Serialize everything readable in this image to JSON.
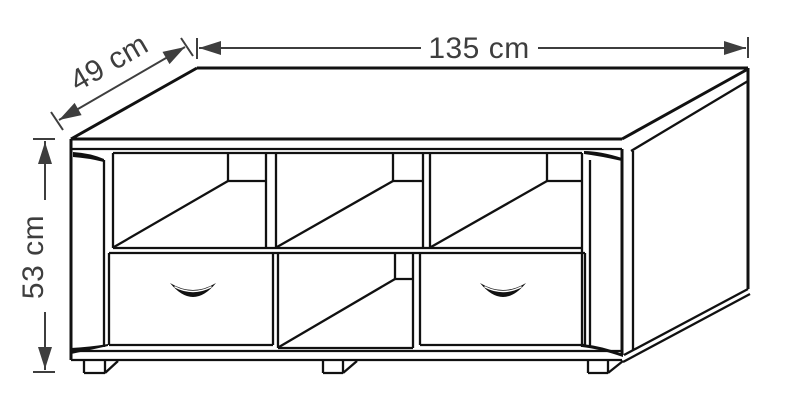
{
  "style": {
    "line_color": "#111111",
    "dim_color": "#3e3e3e",
    "bg": "#ffffff"
  },
  "dimensions": {
    "width": {
      "label": "135 cm"
    },
    "depth": {
      "label": "49 cm"
    },
    "height": {
      "label": "53 cm"
    }
  },
  "diagram": {
    "canvas": {
      "w": 800,
      "h": 418
    },
    "labels": {
      "width": {
        "text": "135 cm",
        "transform": "translate(479,58)"
      },
      "depth": {
        "text": "49 cm",
        "transform": "translate(114,71) rotate(-30)"
      },
      "height": {
        "text": "53 cm",
        "transform": "translate(43,257) rotate(-90)"
      }
    },
    "segments": [
      {
        "n": "top-front-edge",
        "p": [
          71,
          139,
          622,
          139
        ],
        "w": 3
      },
      {
        "n": "top-slab-underside-front",
        "p": [
          71,
          149,
          622,
          149
        ]
      },
      {
        "n": "top-right-edge",
        "p": [
          622,
          139,
          748,
          69
        ],
        "w": 3
      },
      {
        "n": "top-slab-underside-right",
        "p": [
          631,
          151,
          748,
          81
        ]
      },
      {
        "n": "top-back-edge",
        "p": [
          197,
          68,
          748,
          68
        ],
        "w": 3
      },
      {
        "n": "top-left-edge",
        "p": [
          71,
          139,
          197,
          68
        ],
        "w": 3
      },
      {
        "n": "back-right-corner-edge",
        "p": [
          748,
          68,
          748,
          289
        ],
        "w": 3
      },
      {
        "n": "left-outer-edge",
        "p": [
          71,
          139,
          71,
          360
        ],
        "w": 3
      },
      {
        "n": "left-pillar-inner-edge",
        "p": [
          104,
          160,
          104,
          347
        ]
      },
      {
        "n": "opening-left-wall",
        "p": [
          113,
          153,
          113,
          248
        ]
      },
      {
        "n": "right-pillar-outer-edge",
        "p": [
          622,
          149,
          622,
          355
        ],
        "w": 3
      },
      {
        "n": "right-pillar-inner-edge",
        "p": [
          590,
          160,
          590,
          346
        ]
      },
      {
        "n": "opening-right-wall",
        "p": [
          582,
          153,
          582,
          347
        ]
      },
      {
        "n": "side-panel-front-edge",
        "p": [
          633,
          151,
          633,
          350
        ]
      },
      {
        "n": "opening-top-edge",
        "p": [
          113,
          153,
          582,
          153
        ]
      },
      {
        "n": "divider1-left-edge",
        "p": [
          266,
          153,
          266,
          248
        ]
      },
      {
        "n": "divider1-right-edge",
        "p": [
          276,
          153,
          276,
          248
        ]
      },
      {
        "n": "divider2-left-edge",
        "p": [
          423,
          153,
          423,
          248
        ]
      },
      {
        "n": "divider2-right-edge",
        "p": [
          430,
          153,
          430,
          248
        ]
      },
      {
        "n": "cubby-left-depth-diagonal",
        "p": [
          114,
          247,
          228,
          181
        ]
      },
      {
        "n": "cubby-left-back-bottom",
        "p": [
          228,
          181,
          266,
          181
        ]
      },
      {
        "n": "cubby-left-back-corner",
        "p": [
          228,
          153,
          228,
          181
        ]
      },
      {
        "n": "cubby-mid-depth-diagonal",
        "p": [
          277,
          247,
          393,
          181
        ]
      },
      {
        "n": "cubby-mid-back-bottom",
        "p": [
          393,
          181,
          423,
          181
        ]
      },
      {
        "n": "cubby-mid-back-corner",
        "p": [
          393,
          153,
          393,
          181
        ]
      },
      {
        "n": "cubby-right-depth-diagonal",
        "p": [
          431,
          247,
          547,
          181
        ]
      },
      {
        "n": "cubby-right-back-bottom",
        "p": [
          547,
          181,
          582,
          181
        ]
      },
      {
        "n": "cubby-right-back-corner",
        "p": [
          547,
          153,
          547,
          181
        ]
      },
      {
        "n": "mid-shelf-top-edge",
        "p": [
          113,
          248,
          582,
          248
        ]
      },
      {
        "n": "mid-shelf-bottom-edge",
        "p": [
          109,
          253,
          585,
          253
        ]
      },
      {
        "n": "left-drawer-left-edge",
        "p": [
          109,
          253,
          109,
          345
        ]
      },
      {
        "n": "left-drawer-right-edge",
        "p": [
          273,
          253,
          273,
          345
        ]
      },
      {
        "n": "left-drawer-bottom-edge",
        "p": [
          109,
          345,
          273,
          345
        ]
      },
      {
        "n": "lower-comp-left-wall",
        "p": [
          278,
          253,
          278,
          348
        ]
      },
      {
        "n": "lower-comp-right-wall",
        "p": [
          413,
          253,
          413,
          348
        ]
      },
      {
        "n": "lower-comp-bottom-edge",
        "p": [
          278,
          348,
          413,
          348
        ]
      },
      {
        "n": "lower-comp-depth-diagonal",
        "p": [
          279,
          347,
          395,
          279
        ]
      },
      {
        "n": "lower-comp-back-bottom",
        "p": [
          395,
          279,
          413,
          279
        ]
      },
      {
        "n": "lower-comp-back-corner",
        "p": [
          395,
          253,
          395,
          279
        ]
      },
      {
        "n": "right-drawer-left-edge",
        "p": [
          420,
          253,
          420,
          345
        ]
      },
      {
        "n": "right-drawer-right-edge",
        "p": [
          585,
          253,
          585,
          345
        ]
      },
      {
        "n": "right-drawer-bottom-edge",
        "p": [
          420,
          345,
          585,
          345
        ]
      },
      {
        "n": "plinth-top-edge",
        "p": [
          71,
          351,
          622,
          351
        ]
      },
      {
        "n": "plinth-bottom-edge",
        "p": [
          71,
          360,
          622,
          360
        ]
      },
      {
        "n": "base-right-top-diagonal",
        "p": [
          624,
          355,
          748,
          289
        ]
      },
      {
        "n": "base-right-bottom-diagonal",
        "p": [
          623,
          362,
          750,
          294
        ]
      },
      {
        "n": "foot1-left-edge",
        "p": [
          84,
          360,
          84,
          373
        ]
      },
      {
        "n": "foot1-bottom-edge",
        "p": [
          84,
          373,
          105,
          373
        ]
      },
      {
        "n": "foot1-right-edge",
        "p": [
          105,
          360,
          105,
          373
        ]
      },
      {
        "n": "foot1-depth-edge",
        "p": [
          105,
          373,
          118,
          361
        ]
      },
      {
        "n": "foot2-left-edge",
        "p": [
          323,
          360,
          323,
          373
        ]
      },
      {
        "n": "foot2-bottom-edge",
        "p": [
          323,
          373,
          343,
          373
        ]
      },
      {
        "n": "foot2-right-edge",
        "p": [
          343,
          360,
          343,
          373
        ]
      },
      {
        "n": "foot2-depth-edge",
        "p": [
          343,
          373,
          357,
          361
        ]
      },
      {
        "n": "foot3-left-edge",
        "p": [
          588,
          360,
          588,
          373
        ]
      },
      {
        "n": "foot3-bottom-edge",
        "p": [
          588,
          373,
          608,
          373
        ]
      },
      {
        "n": "foot3-right-edge",
        "p": [
          608,
          360,
          608,
          373
        ]
      },
      {
        "n": "foot3-depth-edge",
        "p": [
          608,
          373,
          623,
          361
        ]
      },
      {
        "n": "width-dim-tick-left",
        "p": [
          197,
          38,
          197,
          59
        ],
        "c": "dim",
        "w": 2
      },
      {
        "n": "width-dim-tick-right",
        "p": [
          748,
          37,
          748,
          58
        ],
        "c": "dim",
        "w": 2
      },
      {
        "n": "width-dim-line-left",
        "p": [
          199,
          48,
          421,
          48
        ],
        "c": "dim",
        "w": 2
      },
      {
        "n": "width-dim-line-right",
        "p": [
          538,
          48,
          746,
          48
        ],
        "c": "dim",
        "w": 2
      },
      {
        "n": "depth-dim-line",
        "p": [
          59,
          120,
          185,
          47
        ],
        "c": "dim",
        "w": 2
      },
      {
        "n": "depth-dim-tick-bottom",
        "p": [
          51,
          112,
          63,
          130
        ],
        "c": "dim",
        "w": 2
      },
      {
        "n": "depth-dim-tick-top",
        "p": [
          181,
          38,
          193,
          56
        ],
        "c": "dim",
        "w": 2
      },
      {
        "n": "height-dim-line-top",
        "p": [
          45,
          141,
          45,
          200
        ],
        "c": "dim",
        "w": 2
      },
      {
        "n": "height-dim-line-bottom",
        "p": [
          45,
          312,
          45,
          370
        ],
        "c": "dim",
        "w": 2
      },
      {
        "n": "height-dim-tick-top",
        "p": [
          33,
          139,
          55,
          139
        ],
        "c": "dim",
        "w": 2
      },
      {
        "n": "height-dim-tick-bottom",
        "p": [
          33,
          372,
          55,
          372
        ],
        "c": "dim",
        "w": 2
      }
    ],
    "shapes": [
      {
        "n": "width-dim-arrow-left",
        "d": "M199,48 L221,41 L221,55 Z",
        "f": "dim"
      },
      {
        "n": "width-dim-arrow-right",
        "d": "M746,48 L724,41 L724,55 Z",
        "f": "dim"
      },
      {
        "n": "depth-dim-arrow-bottom",
        "d": "M59,120 L74.6,102.9 L81.6,115.1 Z",
        "f": "dim"
      },
      {
        "n": "depth-dim-arrow-top",
        "d": "M185,47 L169.5,64.1 L162.5,51.9 Z",
        "f": "dim"
      },
      {
        "n": "height-dim-arrow-up",
        "d": "M45,142 L52,164 L38,164 Z",
        "f": "dim"
      },
      {
        "n": "height-dim-arrow-down",
        "d": "M45,369 L52,347 L38,347 Z",
        "f": "dim"
      },
      {
        "n": "trim-top-left",
        "d": "M73,152 Q90,153 104,159 L104,162 Q88,158 73,157 Z",
        "f": "line"
      },
      {
        "n": "trim-top-right",
        "d": "M584,151 Q600,151 622,158 L622,161 Q600,156 584,154 Z",
        "f": "line"
      },
      {
        "n": "trim-bottom-left",
        "d": "M71,348 Q90,347 108,344 L108,346 Q90,350 71,354 Z",
        "f": "line"
      },
      {
        "n": "trim-bottom-right",
        "d": "M582,344 Q602,346 623,354 L623,357 Q600,349 582,347 Z",
        "f": "line"
      },
      {
        "n": "left-drawer-handle",
        "d": "M170,283 Q193,297 216,283 Q193,311 170,283 Z",
        "f": "line"
      },
      {
        "n": "left-drawer-handle-highlight",
        "d": "M175,287 Q193,296 211,287",
        "s": "#ffffff",
        "w": 1.4
      },
      {
        "n": "right-drawer-handle",
        "d": "M480,283 Q503,297 526,283 Q503,311 480,283 Z",
        "f": "line"
      },
      {
        "n": "right-drawer-handle-highlight",
        "d": "M485,287 Q503,296 521,287",
        "s": "#ffffff",
        "w": 1.4
      }
    ]
  }
}
